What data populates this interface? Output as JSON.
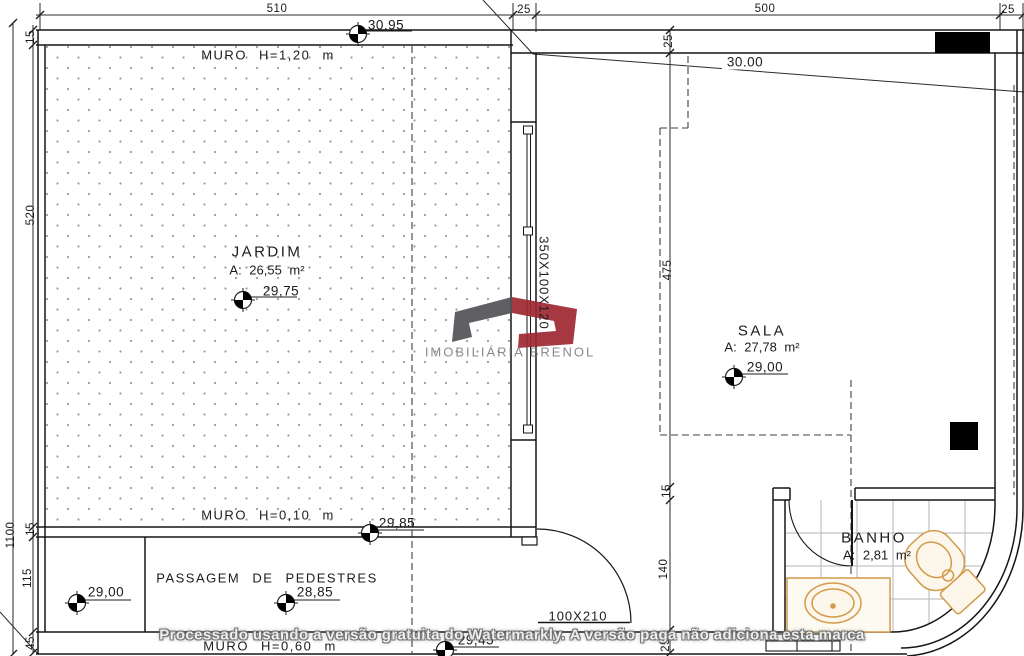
{
  "plan": {
    "rooms": {
      "jardim": {
        "name": "JARDIM",
        "area": "A:  26,55  m²"
      },
      "sala": {
        "name": "SALA",
        "area": "A:  27,78  m²"
      },
      "banho": {
        "name": "BANHO",
        "area": "A:  2,81  m²"
      }
    },
    "walls": {
      "top": "MURO  H=1,20  m",
      "mid": "MURO  H=0,10  m",
      "bottom": "MURO  H=0,60  m"
    },
    "passage_label": "PASSAGEM  DE  PEDESTRES",
    "elevations": {
      "street": "30,95",
      "terrain": "30.00",
      "jardim": "29,75",
      "sala": "29,00",
      "muro": "29,85",
      "passage_left": "29,00",
      "passage_right": "28,85",
      "bottom": "29,45"
    },
    "openings": {
      "window": "350X100X120",
      "door": "100X210"
    },
    "dims": {
      "top": [
        "510",
        "25",
        "500",
        "25"
      ],
      "left_outer": "1100",
      "left_inner": [
        "15",
        "520",
        "15",
        "115",
        "45"
      ],
      "right": [
        "25",
        "475",
        "15",
        "140",
        "25"
      ]
    }
  },
  "branding": {
    "logo_text": "IMOBILIÁRIA BRENOL"
  },
  "watermark": {
    "text": "Processado usando a versão gratuita do Watermarkly. A versão paga não adiciona esta marca"
  },
  "colors": {
    "line": "#1d1d1d",
    "fixture": "#d39a4a",
    "fixture_fill": "#fcf7ea",
    "tile": "#b5b5b5",
    "stipple": "#9b9b9b",
    "logo_gray": "#535357",
    "logo_red": "#9f2833"
  }
}
